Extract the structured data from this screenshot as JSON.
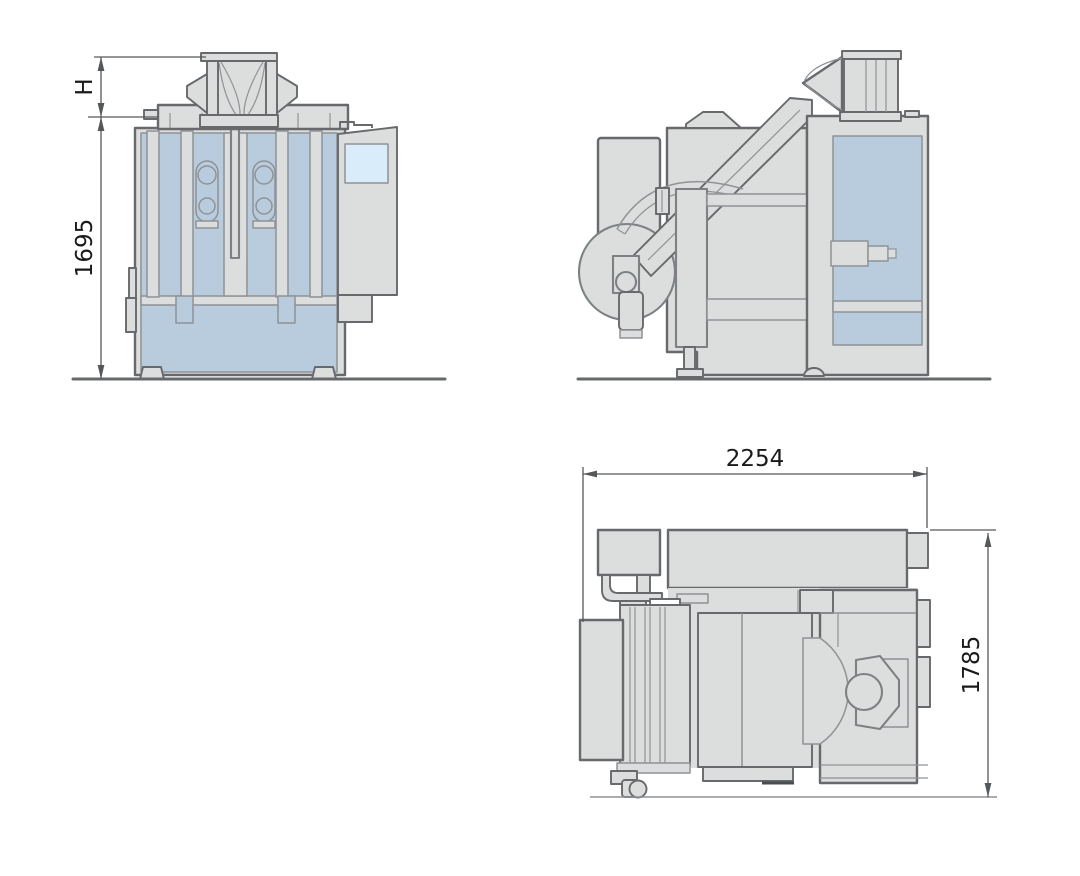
{
  "palette": {
    "bg": "#ffffff",
    "body": "#dcdddd",
    "outline": "#67696c",
    "line": "#8f9296",
    "accent_blue": "#b8ccdd",
    "screen_blue": "#d9ecf9",
    "dim_line": "#55585a",
    "dim_text": "#1a1a1a"
  },
  "dimensions": {
    "hopper_height": {
      "label": "H"
    },
    "machine_height": {
      "value": "1695"
    },
    "machine_width": {
      "value": "2254"
    },
    "machine_depth": {
      "value": "1785"
    }
  }
}
